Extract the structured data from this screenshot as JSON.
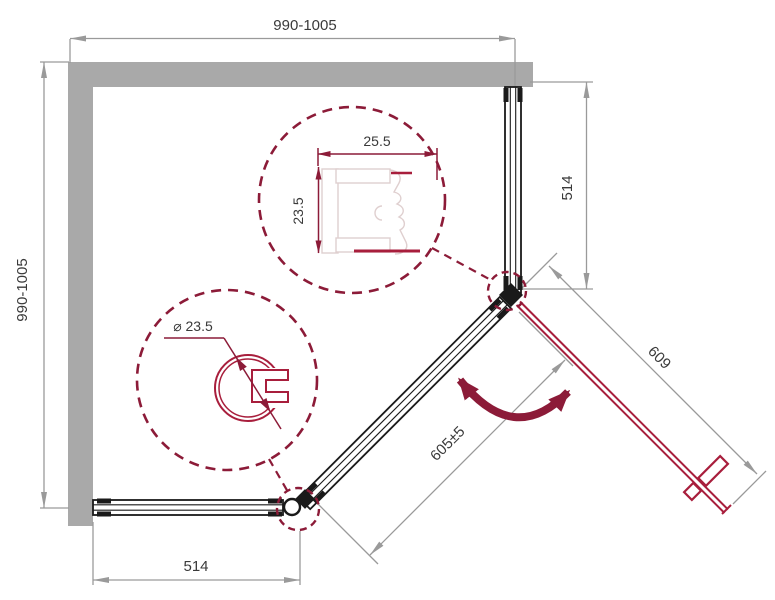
{
  "title": "Shower enclosure dimension diagram",
  "dimensions": {
    "top_width": "990-1005",
    "left_depth": "990-1005",
    "right_fixed_panel": "514",
    "bottom_fixed_panel": "514",
    "door_width": "609",
    "diagonal_opening": "605±5"
  },
  "profile_details": {
    "wall_profile_width": "25.5",
    "wall_profile_depth": "23.5",
    "corner_post_diameter": "⌀ 23.5"
  },
  "colors": {
    "wall": "#a9a9a9",
    "dim": "#9a9a9a",
    "text": "#3a3a3a",
    "frame": "#1a1a1a",
    "door": "#a81e3c",
    "maroon": "#8c1b38",
    "plight": "#dfcfcf"
  }
}
